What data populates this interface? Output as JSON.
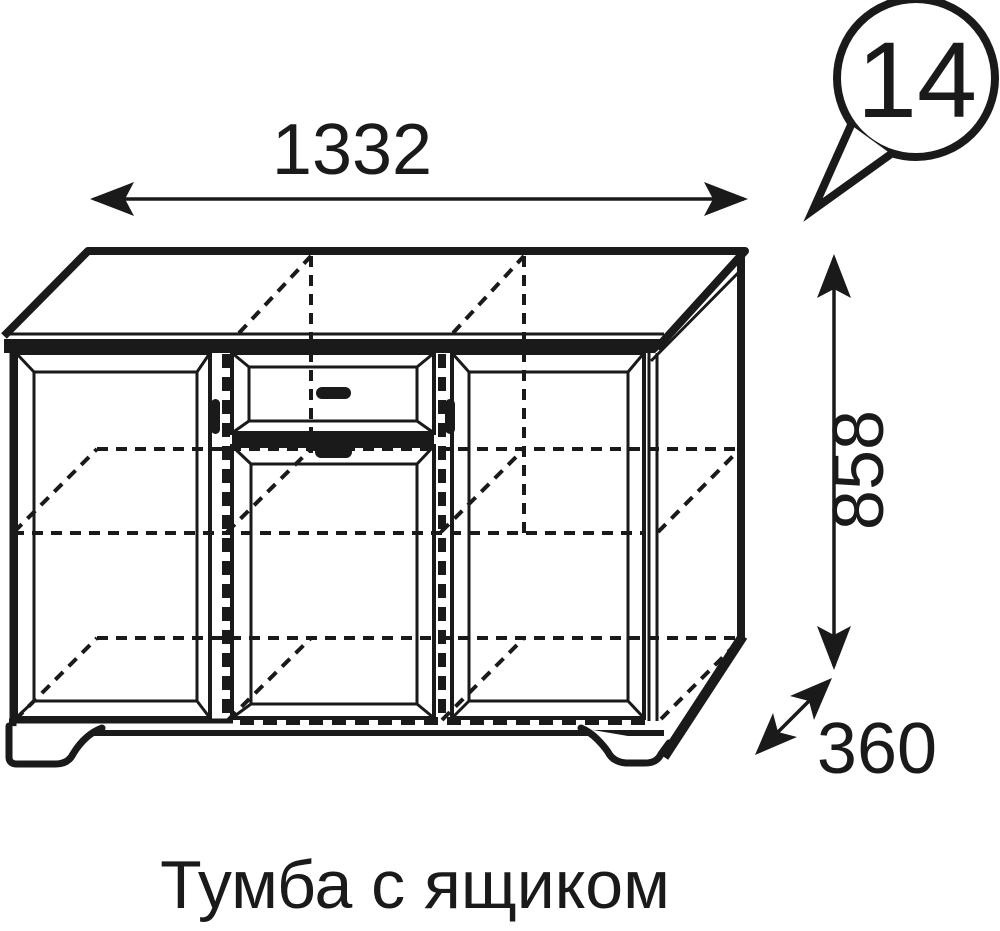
{
  "callout": {
    "number": "14"
  },
  "dimensions": {
    "width": "1332",
    "height": "858",
    "depth": "360"
  },
  "caption": "Тумба с ящиком",
  "drawing": {
    "type": "furniture-technical-drawing",
    "item": "cabinet with drawer",
    "sections": [
      "left door",
      "drawer",
      "middle door",
      "right door"
    ],
    "colors": {
      "line": "#1a1a1a",
      "background": "#ffffff"
    }
  }
}
